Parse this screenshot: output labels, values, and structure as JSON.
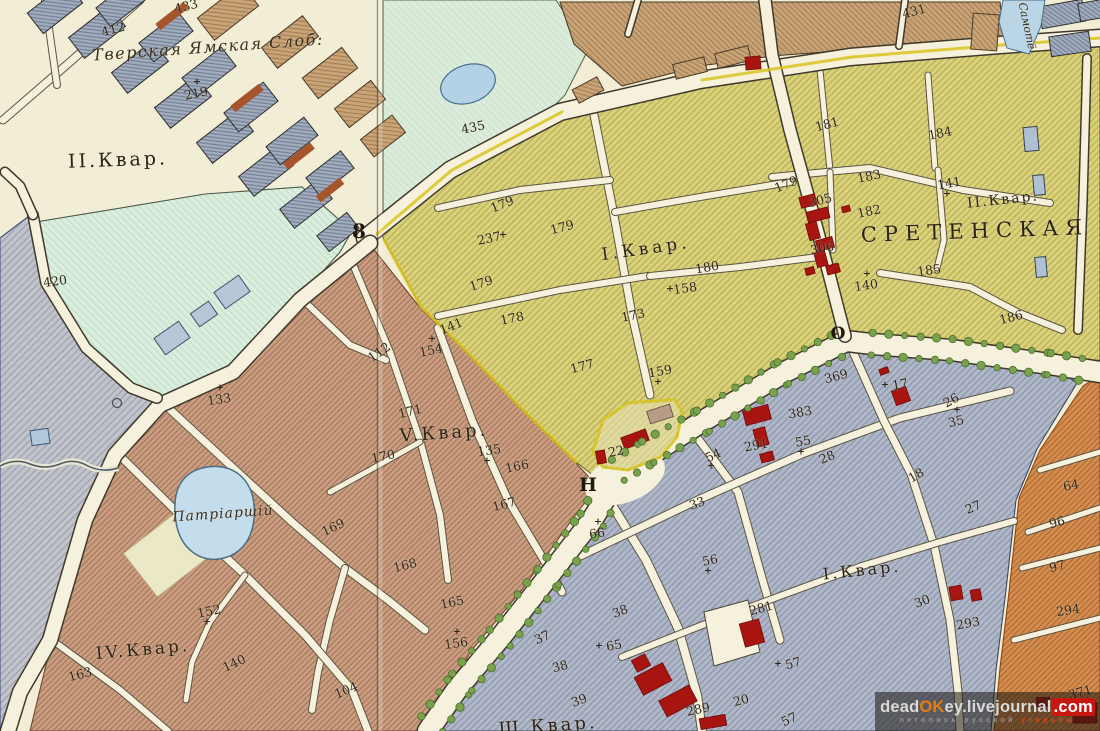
{
  "map": {
    "labels": [
      {
        "t": "Тверская Ямская Слоб:",
        "x": 208,
        "y": 47,
        "s": 16,
        "r": -4,
        "k": "script",
        "ls": 1.5
      },
      {
        "t": "II.Квар.",
        "x": 118,
        "y": 160,
        "s": 19,
        "r": -2,
        "k": "region",
        "ls": 3
      },
      {
        "t": "I.Квар.",
        "x": 646,
        "y": 249,
        "s": 17,
        "r": -8,
        "k": "region",
        "ls": 4
      },
      {
        "t": "II.Квар.",
        "x": 1003,
        "y": 200,
        "s": 14,
        "r": -6,
        "k": "region",
        "ls": 2
      },
      {
        "t": "СРЕТЕНСКАЯ",
        "x": 975,
        "y": 231,
        "s": 21,
        "r": -2,
        "k": "region",
        "ls": 7
      },
      {
        "t": "V.Квар.",
        "x": 444,
        "y": 433,
        "s": 18,
        "r": -4,
        "k": "region",
        "ls": 3
      },
      {
        "t": "IV.Квар.",
        "x": 143,
        "y": 650,
        "s": 17,
        "r": -5,
        "k": "region",
        "ls": 3
      },
      {
        "t": "Ш.Квар.",
        "x": 548,
        "y": 726,
        "s": 18,
        "r": -4,
        "k": "region",
        "ls": 3
      },
      {
        "t": "I.Квар.",
        "x": 862,
        "y": 570,
        "s": 16,
        "r": -6,
        "k": "region",
        "ls": 3
      },
      {
        "t": "Патріаршій",
        "x": 223,
        "y": 514,
        "s": 14,
        "r": -4,
        "k": "script",
        "ls": 1
      },
      {
        "t": "Самотё",
        "x": 1027,
        "y": 26,
        "s": 11,
        "r": 78,
        "k": "script",
        "ls": 0
      },
      {
        "t": "8",
        "x": 359,
        "y": 231,
        "s": 20,
        "r": 0,
        "k": "gate"
      },
      {
        "t": "Н",
        "x": 588,
        "y": 485,
        "s": 19,
        "r": 0,
        "k": "gate"
      },
      {
        "t": "О",
        "x": 838,
        "y": 334,
        "s": 17,
        "r": 0,
        "k": "gate"
      },
      {
        "t": "433",
        "x": 186,
        "y": 6,
        "r": -15,
        "k": "num"
      },
      {
        "t": "412",
        "x": 113,
        "y": 29,
        "r": -15,
        "k": "num"
      },
      {
        "t": "219",
        "x": 196,
        "y": 93,
        "r": -12,
        "k": "num",
        "c": "above"
      },
      {
        "t": "435",
        "x": 473,
        "y": 127,
        "r": -12,
        "k": "num"
      },
      {
        "t": "431",
        "x": 914,
        "y": 11,
        "r": -15,
        "k": "num"
      },
      {
        "t": "420",
        "x": 55,
        "y": 281,
        "r": -8,
        "k": "num"
      },
      {
        "t": "133",
        "x": 219,
        "y": 399,
        "r": -8,
        "k": "num",
        "c": "above"
      },
      {
        "t": "237",
        "x": 489,
        "y": 238,
        "r": -12,
        "k": "num",
        "c": "right"
      },
      {
        "t": "179",
        "x": 502,
        "y": 204,
        "r": -22,
        "k": "num"
      },
      {
        "t": "179",
        "x": 562,
        "y": 227,
        "r": -15,
        "k": "num"
      },
      {
        "t": "179",
        "x": 481,
        "y": 283,
        "r": -18,
        "k": "num"
      },
      {
        "t": "178",
        "x": 512,
        "y": 318,
        "r": -12,
        "k": "num"
      },
      {
        "t": "141",
        "x": 451,
        "y": 326,
        "r": -22,
        "k": "num"
      },
      {
        "t": "154",
        "x": 431,
        "y": 350,
        "r": -12,
        "k": "num",
        "c": "above"
      },
      {
        "t": "112",
        "x": 379,
        "y": 352,
        "r": -35,
        "k": "num"
      },
      {
        "t": "171",
        "x": 410,
        "y": 411,
        "r": -14,
        "k": "num"
      },
      {
        "t": "170",
        "x": 383,
        "y": 456,
        "r": -12,
        "k": "num"
      },
      {
        "t": "135",
        "x": 489,
        "y": 450,
        "r": -8,
        "k": "num",
        "c": "below"
      },
      {
        "t": "166",
        "x": 517,
        "y": 466,
        "r": -12,
        "k": "num"
      },
      {
        "t": "167",
        "x": 504,
        "y": 504,
        "r": -15,
        "k": "num"
      },
      {
        "t": "177",
        "x": 582,
        "y": 366,
        "r": -15,
        "k": "num"
      },
      {
        "t": "173",
        "x": 633,
        "y": 315,
        "r": -12,
        "k": "num"
      },
      {
        "t": "180",
        "x": 707,
        "y": 267,
        "r": -10,
        "k": "num"
      },
      {
        "t": "158",
        "x": 685,
        "y": 288,
        "r": -8,
        "k": "num",
        "c": "left"
      },
      {
        "t": "159",
        "x": 660,
        "y": 371,
        "r": -10,
        "k": "num",
        "c": "below"
      },
      {
        "t": "181",
        "x": 827,
        "y": 124,
        "r": -15,
        "k": "num"
      },
      {
        "t": "184",
        "x": 940,
        "y": 133,
        "r": -12,
        "k": "num"
      },
      {
        "t": "183",
        "x": 869,
        "y": 176,
        "r": -12,
        "k": "num"
      },
      {
        "t": "141",
        "x": 949,
        "y": 183,
        "r": -10,
        "k": "num",
        "c": "below"
      },
      {
        "t": "179",
        "x": 786,
        "y": 184,
        "r": -22,
        "k": "num"
      },
      {
        "t": "305",
        "x": 820,
        "y": 200,
        "r": -15,
        "k": "num"
      },
      {
        "t": "182",
        "x": 869,
        "y": 211,
        "r": -12,
        "k": "num"
      },
      {
        "t": "306",
        "x": 822,
        "y": 248,
        "r": -10,
        "k": "num"
      },
      {
        "t": "140",
        "x": 866,
        "y": 285,
        "r": -8,
        "k": "num",
        "c": "above"
      },
      {
        "t": "185",
        "x": 929,
        "y": 270,
        "r": -8,
        "k": "num"
      },
      {
        "t": "186",
        "x": 1011,
        "y": 317,
        "r": -15,
        "k": "num"
      },
      {
        "t": "22",
        "x": 616,
        "y": 451,
        "r": -10,
        "k": "num"
      },
      {
        "t": "66",
        "x": 597,
        "y": 533,
        "r": -8,
        "k": "num",
        "c": "above"
      },
      {
        "t": "369",
        "x": 836,
        "y": 376,
        "r": -15,
        "k": "num"
      },
      {
        "t": "383",
        "x": 800,
        "y": 412,
        "r": -10,
        "k": "num"
      },
      {
        "t": "291",
        "x": 756,
        "y": 445,
        "r": -10,
        "k": "num"
      },
      {
        "t": "55",
        "x": 803,
        "y": 441,
        "r": -10,
        "k": "num",
        "c": "below"
      },
      {
        "t": "28",
        "x": 827,
        "y": 457,
        "r": -22,
        "k": "num"
      },
      {
        "t": "54",
        "x": 713,
        "y": 455,
        "r": -25,
        "k": "num",
        "c": "below"
      },
      {
        "t": "33",
        "x": 697,
        "y": 503,
        "r": -20,
        "k": "num"
      },
      {
        "t": "56",
        "x": 710,
        "y": 560,
        "r": -12,
        "k": "num",
        "c": "below"
      },
      {
        "t": "17",
        "x": 900,
        "y": 384,
        "r": -10,
        "k": "num",
        "c": "left"
      },
      {
        "t": "26",
        "x": 951,
        "y": 400,
        "r": -28,
        "k": "num"
      },
      {
        "t": "35",
        "x": 956,
        "y": 421,
        "r": -15,
        "k": "num",
        "c": "above"
      },
      {
        "t": "18",
        "x": 916,
        "y": 475,
        "r": -30,
        "k": "num"
      },
      {
        "t": "27",
        "x": 973,
        "y": 507,
        "r": -22,
        "k": "num"
      },
      {
        "t": "38",
        "x": 620,
        "y": 611,
        "r": -20,
        "k": "num"
      },
      {
        "t": "65",
        "x": 614,
        "y": 645,
        "r": -10,
        "k": "num",
        "c": "left"
      },
      {
        "t": "37",
        "x": 542,
        "y": 637,
        "r": -25,
        "k": "num"
      },
      {
        "t": "38",
        "x": 560,
        "y": 666,
        "r": -15,
        "k": "num"
      },
      {
        "t": "39",
        "x": 579,
        "y": 700,
        "r": -20,
        "k": "num"
      },
      {
        "t": "281",
        "x": 761,
        "y": 608,
        "r": -15,
        "k": "num"
      },
      {
        "t": "57",
        "x": 793,
        "y": 663,
        "r": -15,
        "k": "num",
        "c": "left"
      },
      {
        "t": "289",
        "x": 698,
        "y": 709,
        "r": -12,
        "k": "num"
      },
      {
        "t": "20",
        "x": 741,
        "y": 700,
        "r": -15,
        "k": "num"
      },
      {
        "t": "57",
        "x": 789,
        "y": 719,
        "r": -25,
        "k": "num"
      },
      {
        "t": "30",
        "x": 922,
        "y": 601,
        "r": -20,
        "k": "num"
      },
      {
        "t": "293",
        "x": 968,
        "y": 623,
        "r": -10,
        "k": "num"
      },
      {
        "t": "168",
        "x": 405,
        "y": 565,
        "r": -15,
        "k": "num"
      },
      {
        "t": "165",
        "x": 452,
        "y": 602,
        "r": -12,
        "k": "num"
      },
      {
        "t": "156",
        "x": 456,
        "y": 643,
        "r": -8,
        "k": "num",
        "c": "above"
      },
      {
        "t": "104",
        "x": 346,
        "y": 690,
        "r": -22,
        "k": "num"
      },
      {
        "t": "169",
        "x": 333,
        "y": 527,
        "r": -25,
        "k": "num"
      },
      {
        "t": "152",
        "x": 209,
        "y": 611,
        "r": -12,
        "k": "num",
        "c": "below"
      },
      {
        "t": "140",
        "x": 234,
        "y": 663,
        "r": -25,
        "k": "num"
      },
      {
        "t": "163",
        "x": 80,
        "y": 674,
        "r": -15,
        "k": "num"
      },
      {
        "t": "64",
        "x": 1071,
        "y": 485,
        "r": -10,
        "k": "num"
      },
      {
        "t": "96",
        "x": 1057,
        "y": 522,
        "r": -15,
        "k": "num"
      },
      {
        "t": "97",
        "x": 1057,
        "y": 566,
        "r": -15,
        "k": "num"
      },
      {
        "t": "294",
        "x": 1068,
        "y": 610,
        "r": -8,
        "k": "num"
      },
      {
        "t": "371",
        "x": 1080,
        "y": 692,
        "r": -15,
        "k": "num"
      }
    ]
  },
  "watermark": {
    "segments": [
      {
        "t": "dead",
        "c": "#d9d9d7"
      },
      {
        "t": "OK",
        "c": "#e87d12"
      },
      {
        "t": "ey",
        "c": "#d9d9d7"
      },
      {
        "t": ".livejournal",
        "c": "#d9d9d7"
      },
      {
        "t": ".com",
        "c": "#ffffff",
        "bg": "#c81610"
      }
    ],
    "subtitle": [
      {
        "t": "летопись русской ",
        "c": "#98948c"
      },
      {
        "t": "усадьбы",
        "c": "#d44a1a"
      }
    ]
  },
  "colors": {
    "paper": "#f2eed6",
    "road": "#f6f1dc",
    "grey_region": "#c1c3cb",
    "mint": "#dbeede",
    "park": "#dcecda",
    "yellow_quarter": "#d9d17c",
    "brown_quarter": "#c99d82",
    "bluegrey_quarter": "#b0b7c7",
    "orange_blocks": "#d28d51",
    "tan_blocks": "#c8a378",
    "grey_blocks": "#a2acbc",
    "red_building": "#a81511",
    "tree_green": "#7aa24c",
    "water": "#b9d5e6",
    "plot_border": "#d9c41f",
    "ink": "#31281a"
  }
}
